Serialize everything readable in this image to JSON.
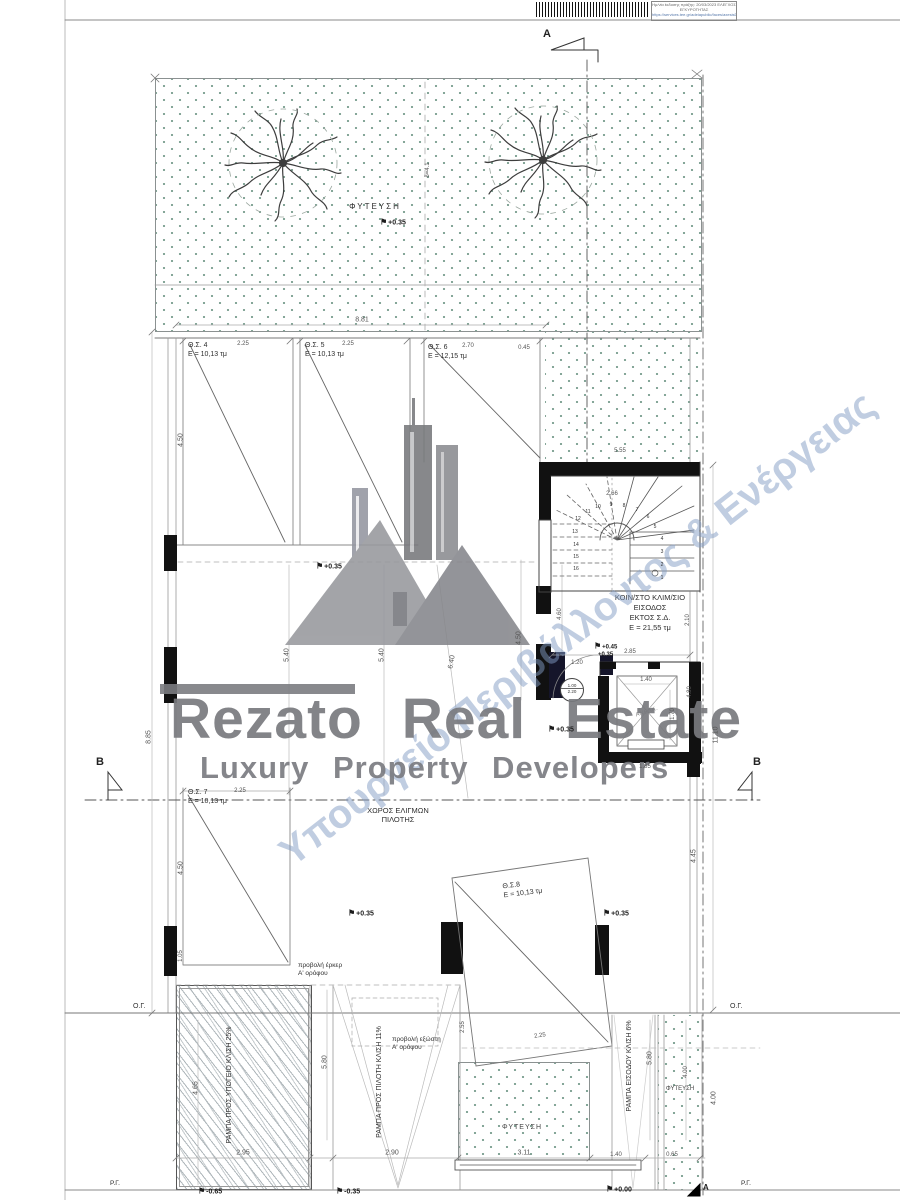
{
  "stamp": {
    "line1": "Ημ/νία έκδοσης πράξης: 20/03/2023",
    "line2": "ΕΛΕΓΧΟΣ ΕΓΚΥΡΟΤΗΤΑΣ",
    "line3": "https://services.tee.gr/adeiapublic/faces/axesisDocFile"
  },
  "watermark": {
    "brand": "Rezato Real Estate",
    "tagline": "Luxury Property Developers",
    "diagonal": "Υπουργείο Περιβάλλοντος & Ενέργειας"
  },
  "section_marks": {
    "top": "A",
    "bottom": "A",
    "left": "B",
    "right": "B"
  },
  "areas": {
    "planting_top": "ΦΥΤΕΥΣΗ",
    "planting_mid": "ΦΥΤΕΥΣΗ",
    "planting_right": "ΦΥΤΕΥΣΗ",
    "maneuver_l1": "ΧΩΡΟΣ ΕΛΙΓΜΩΝ",
    "maneuver_l2": "ΠΙΛΟΤΗΣ",
    "stair_l1": "ΚΟΙΝ/ΣΤΟ ΚΛΙΜ/ΣΙΟ",
    "stair_l2": "ΕΙΣΟΔΟΣ",
    "stair_l3": "ΕΚΤΟΣ Σ.Δ.",
    "stair_l4": "Ε = 21,55 τμ",
    "elevator": "ΑΝΕΛΚ.",
    "erker_l1": "προβολή έρκερ",
    "erker_l2": "Α' ορόφου",
    "exosti_l1": "προβολή εξώστη",
    "exosti_l2": "Α' ορόφου",
    "ramp1_l1": "ΡΑΜΠΑ ΠΡΟΣ ΥΠΟΓΕΙΟ",
    "ramp1_l2": "ΚΛΙΣΗ 25%",
    "ramp2_l1": "ΡΑΜΠΑ ΠΡΟΣ ΠΙΛΟΤΗ",
    "ramp2_l2": "ΚΛΙΣΗ 11%",
    "ramp3_l1": "ΡΑΜΠΑ ΕΙΣΟΔΟΥ",
    "ramp3_l2": "ΚΛΙΣΗ 6%",
    "og": "Ο.Γ.",
    "rg": "Ρ.Γ.",
    "door_w": "1.00",
    "door_h": "2.20"
  },
  "parking": [
    {
      "name": "Θ.Σ. 4",
      "area": "Ε = 10,13 τμ"
    },
    {
      "name": "Θ.Σ. 5",
      "area": "Ε = 10,13 τμ"
    },
    {
      "name": "Θ.Σ. 6",
      "area": "Ε = 12,15 τμ"
    },
    {
      "name": "Θ.Σ. 7",
      "area": "Ε = 10,13 τμ"
    },
    {
      "name": "Θ.Σ.8",
      "area": "Ε = 10,13 τμ"
    }
  ],
  "stair_numbers": [
    "1",
    "2",
    "3",
    "4",
    "5",
    "6",
    "7",
    "8",
    "9",
    "10",
    "11",
    "12",
    "13",
    "14",
    "15",
    "16"
  ],
  "dims": [
    {
      "t": "8.81",
      "x": 362,
      "y": 320
    },
    {
      "t": "2.25",
      "x": 243,
      "y": 344,
      "fs": 6
    },
    {
      "t": "2.25",
      "x": 348,
      "y": 344,
      "fs": 6
    },
    {
      "t": "2.70",
      "x": 468,
      "y": 346,
      "fs": 6
    },
    {
      "t": "0.45",
      "x": 524,
      "y": 348,
      "fs": 6
    },
    {
      "t": "δ=4.1",
      "x": 428,
      "y": 170,
      "r": -90,
      "fs": 6
    },
    {
      "t": "4.50",
      "x": 181,
      "y": 440,
      "r": -90
    },
    {
      "t": "8.85",
      "x": 149,
      "y": 737,
      "r": -90
    },
    {
      "t": "5.55",
      "x": 620,
      "y": 451,
      "fs": 6
    },
    {
      "t": "2.66",
      "x": 612,
      "y": 494,
      "fs": 6
    },
    {
      "t": "5.40",
      "x": 287,
      "y": 655,
      "r": -90
    },
    {
      "t": "5.40",
      "x": 382,
      "y": 655,
      "r": -90
    },
    {
      "t": "6.40",
      "x": 452,
      "y": 662,
      "r": -80
    },
    {
      "t": "4.50",
      "x": 519,
      "y": 638,
      "r": -90
    },
    {
      "t": "4.60",
      "x": 560,
      "y": 614,
      "r": -90,
      "fs": 6
    },
    {
      "t": "2.10",
      "x": 688,
      "y": 620,
      "r": -90,
      "fs": 6
    },
    {
      "t": "4.80",
      "x": 690,
      "y": 692,
      "r": -90,
      "fs": 6
    },
    {
      "t": "2.85",
      "x": 630,
      "y": 652,
      "fs": 6
    },
    {
      "t": "1.20",
      "x": 577,
      "y": 663,
      "fs": 6
    },
    {
      "t": "1.40",
      "x": 646,
      "y": 680,
      "fs": 6
    },
    {
      "t": "1.70",
      "x": 673,
      "y": 714,
      "r": -90,
      "fs": 6
    },
    {
      "t": "1.85",
      "x": 645,
      "y": 767,
      "fs": 6
    },
    {
      "t": "11.10",
      "x": 716,
      "y": 735,
      "r": -90
    },
    {
      "t": "4.45",
      "x": 694,
      "y": 856,
      "r": -90
    },
    {
      "t": "2.25",
      "x": 240,
      "y": 791,
      "fs": 6
    },
    {
      "t": "4.50",
      "x": 181,
      "y": 868,
      "r": -90
    },
    {
      "t": "1.05",
      "x": 181,
      "y": 956,
      "r": -90,
      "fs": 6
    },
    {
      "t": "4.65",
      "x": 196,
      "y": 1088,
      "r": -90
    },
    {
      "t": "5.80",
      "x": 325,
      "y": 1062,
      "r": -90
    },
    {
      "t": "2.55",
      "x": 463,
      "y": 1027,
      "r": -90,
      "fs": 6
    },
    {
      "t": "5.80",
      "x": 650,
      "y": 1058,
      "r": -90
    },
    {
      "t": "4.00",
      "x": 686,
      "y": 1072,
      "r": -90,
      "fs": 6
    },
    {
      "t": "4.00",
      "x": 714,
      "y": 1098,
      "r": -90
    },
    {
      "t": "2.95",
      "x": 243,
      "y": 1153
    },
    {
      "t": "2.90",
      "x": 392,
      "y": 1153
    },
    {
      "t": "3.11",
      "x": 524,
      "y": 1153
    },
    {
      "t": "1.40",
      "x": 616,
      "y": 1155,
      "fs": 6
    },
    {
      "t": "0.65",
      "x": 672,
      "y": 1155,
      "fs": 6
    },
    {
      "t": "2.25",
      "x": 540,
      "y": 1036,
      "r": -8,
      "fs": 6
    }
  ],
  "elevations": [
    {
      "t": "+0.35",
      "x": 380,
      "y": 222
    },
    {
      "t": "+0.35",
      "x": 316,
      "y": 566
    },
    {
      "t": "+0.45",
      "x": 594,
      "y": 646,
      "fs": 6
    },
    {
      "t": "+0.35",
      "x": 598,
      "y": 655,
      "fs": 6,
      "nf": true
    },
    {
      "t": "+0.35",
      "x": 548,
      "y": 729
    },
    {
      "t": "+0.35",
      "x": 348,
      "y": 913
    },
    {
      "t": "+0.35",
      "x": 603,
      "y": 913
    },
    {
      "t": "-0.65",
      "x": 198,
      "y": 1191
    },
    {
      "t": "-0.35",
      "x": 336,
      "y": 1191
    },
    {
      "t": "+0.00",
      "x": 606,
      "y": 1189
    }
  ],
  "colors": {
    "planting_dots": "#7fa294",
    "watermark_gray": "#78797e",
    "watermark_blue": "#829bc3",
    "wall_black": "#111111",
    "line": "#555555"
  }
}
